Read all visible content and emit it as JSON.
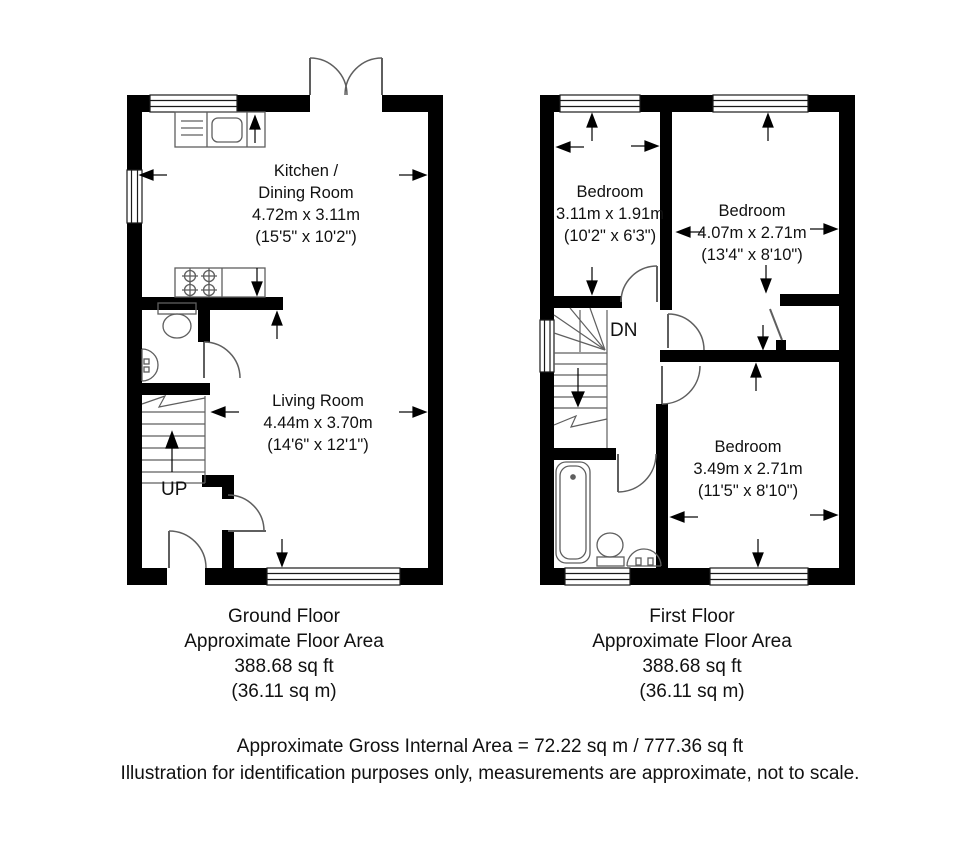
{
  "ground_floor": {
    "caption": [
      "Ground Floor",
      "Approximate Floor Area",
      "388.68 sq ft",
      "(36.11 sq m)"
    ],
    "stairs_label": "UP",
    "rooms": {
      "kitchen": {
        "line1": "Kitchen /",
        "line2": "Dining Room",
        "metric": "4.72m x 3.11m",
        "imperial": "(15'5\" x 10'2\")"
      },
      "living": {
        "line1": "Living Room",
        "metric": "4.44m x 3.70m",
        "imperial": "(14'6\" x 12'1\")"
      }
    }
  },
  "first_floor": {
    "caption": [
      "First Floor",
      "Approximate Floor Area",
      "388.68 sq ft",
      "(36.11 sq m)"
    ],
    "stairs_label": "DN",
    "rooms": {
      "bedroom1": {
        "line1": "Bedroom",
        "metric": "3.11m x 1.91m",
        "imperial": "(10'2\" x 6'3\")"
      },
      "bedroom2": {
        "line1": "Bedroom",
        "metric": "4.07m x 2.71m",
        "imperial": "(13'4\" x 8'10\")"
      },
      "bedroom3": {
        "line1": "Bedroom",
        "metric": "3.49m x 2.71m",
        "imperial": "(11'5\" x 8'10\")"
      }
    }
  },
  "footer": {
    "line1": "Approximate Gross Internal Area = 72.22 sq m / 777.36 sq ft",
    "line2": "Illustration for identification purposes only, measurements are approximate, not to scale."
  },
  "colors": {
    "wall": "#000000",
    "detail_line": "#5f5f5f",
    "window_line": "#1a1a1a",
    "background": "#ffffff",
    "text": "#111111"
  }
}
